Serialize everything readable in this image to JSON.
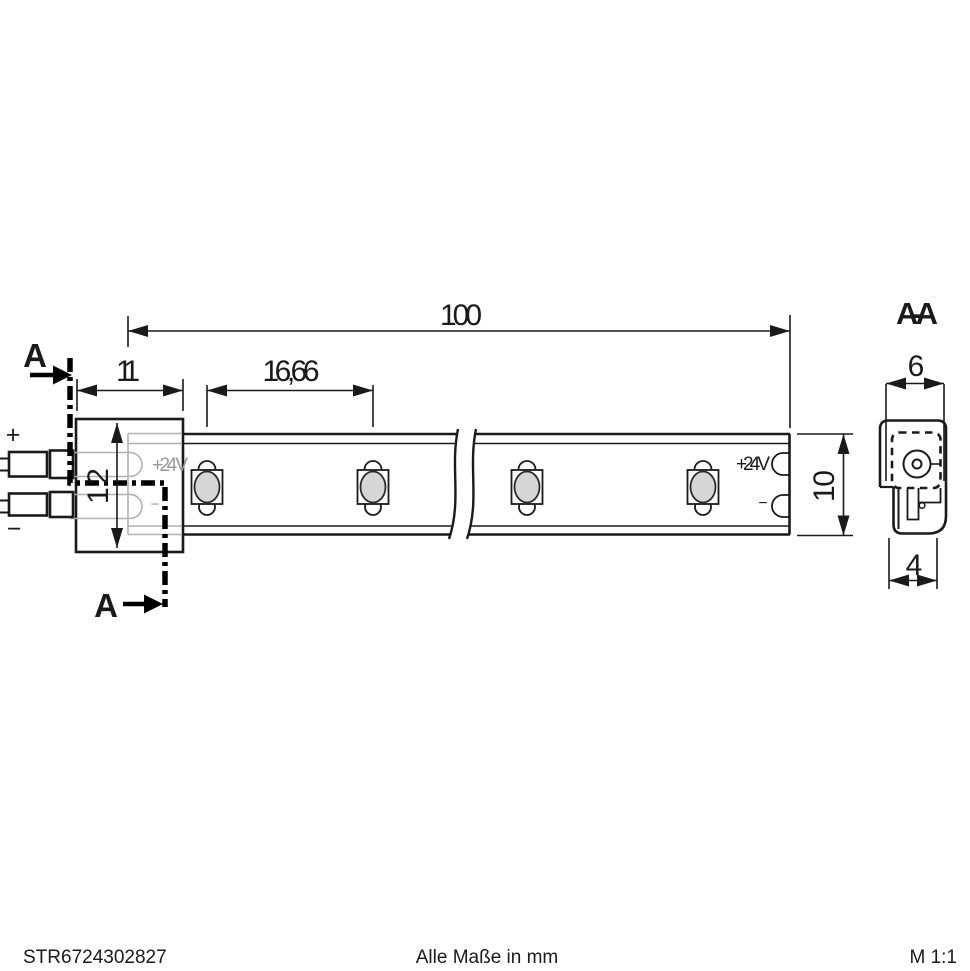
{
  "drawing": {
    "footer": {
      "part_number": "STR6724302827",
      "units_note": "Alle Maße in mm",
      "scale": "M 1:1"
    },
    "dimensions": {
      "total_length": "100",
      "connector_width": "11",
      "led_pitch": "16,66",
      "connector_height": "12",
      "strip_height": "10",
      "section_top_width": "6",
      "section_bottom_width": "4"
    },
    "labels": {
      "section_title": "A-A",
      "cut_mark_top": "A",
      "cut_mark_bottom": "A",
      "wire_plus": "+",
      "wire_minus": "−",
      "pad_supply": "+24 V",
      "pad_minus": "−",
      "hidden_supply": "+24 V",
      "hidden_minus": "−"
    },
    "colors": {
      "line": "#1a1a1a",
      "hidden_line": "#b0b0b0",
      "led_fill": "#d6d6d6",
      "background": "#ffffff"
    }
  }
}
